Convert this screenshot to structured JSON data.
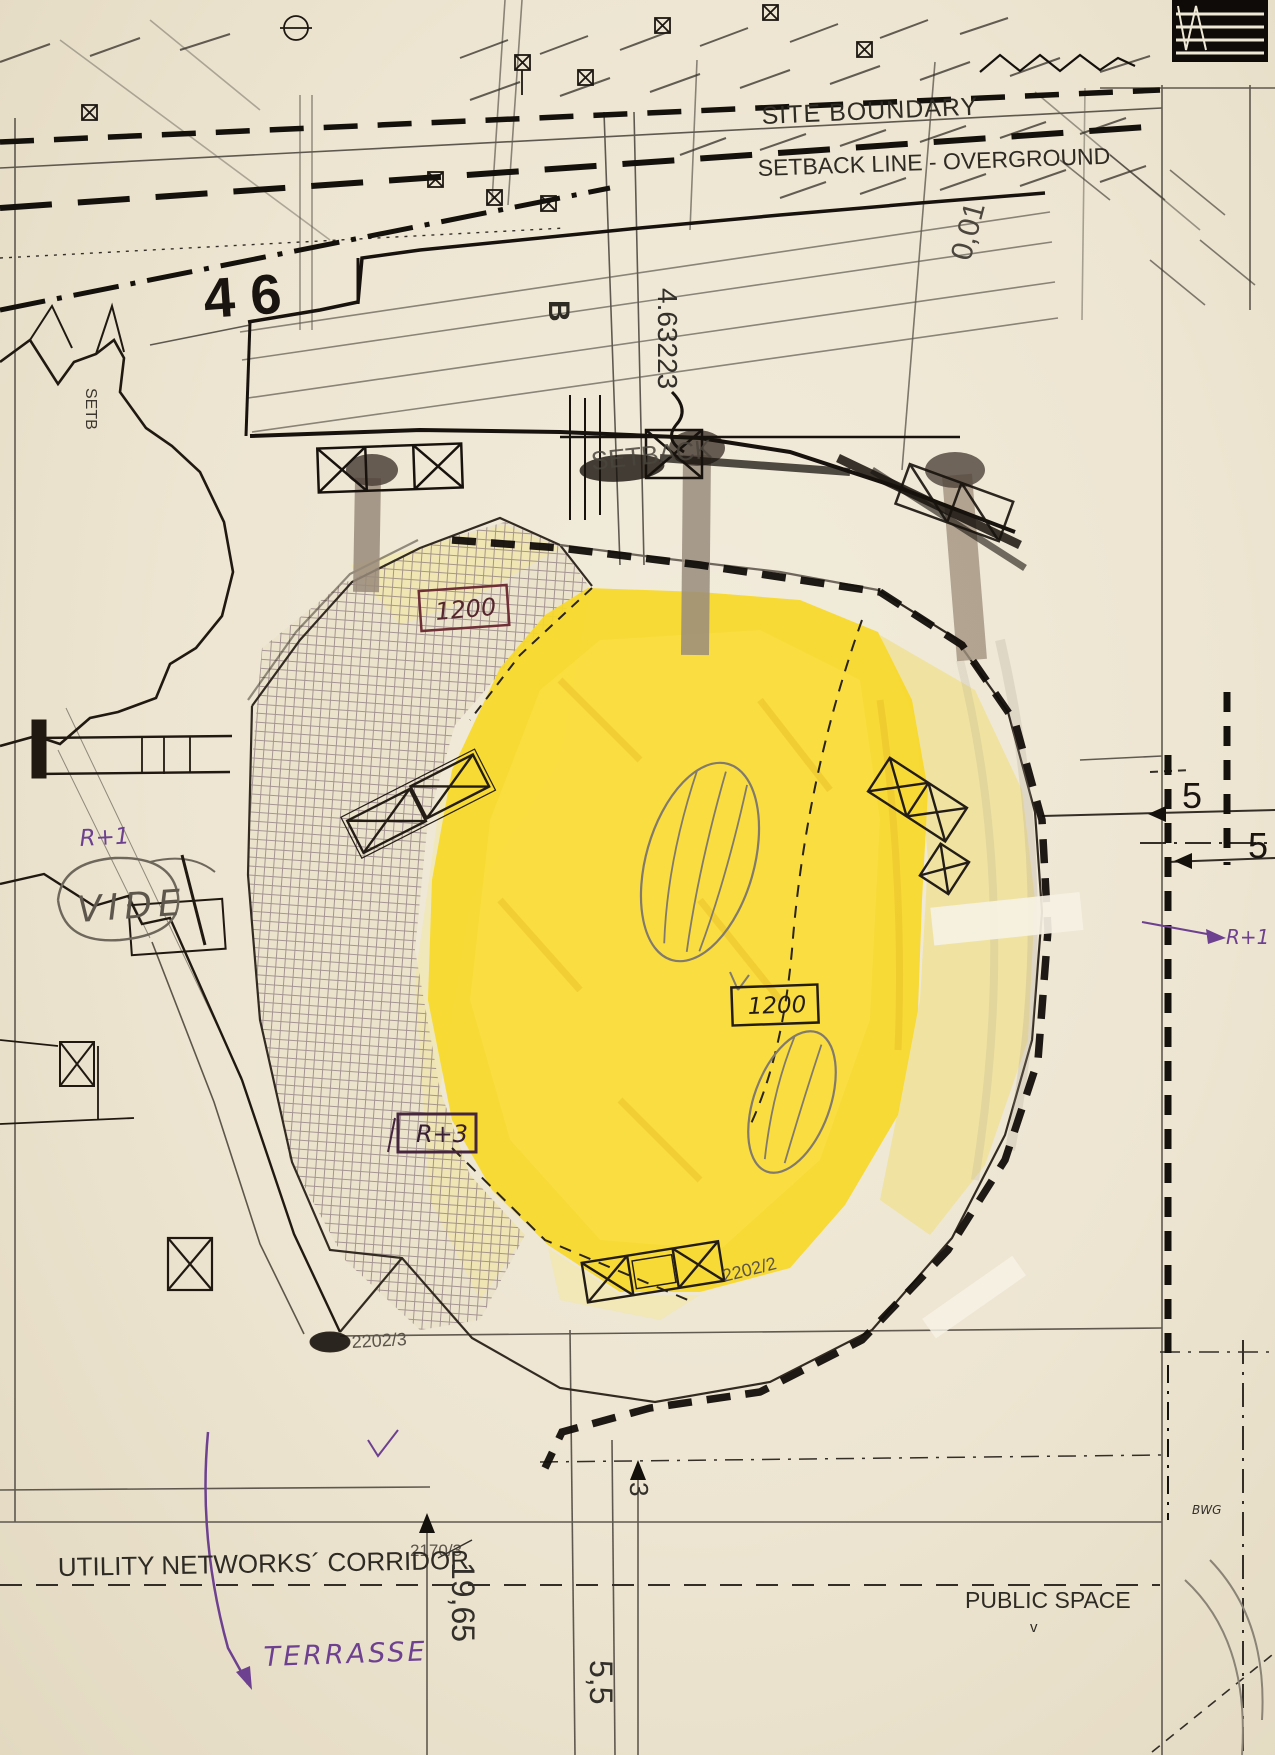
{
  "document": {
    "type": "scanned architectural site-plan sketch",
    "palette": {
      "paper": "#ede5d1",
      "ink": "#1f1911",
      "print_gray": "#4a453d",
      "pencil": "#80796c",
      "yellow_main": "#f7d829",
      "yellow_pale": "#f0e194",
      "purple_annotation": "#6d4190",
      "maroon_pen": "#6e2f36",
      "hatch_grid": "#74616c",
      "column_tan": "#9a8b7b"
    }
  },
  "labels": {
    "site_boundary": "SITE BOUNDARY",
    "setback_overground": "SETBACK LINE - OVERGROUND",
    "dim_001": "0,01",
    "parcel_46": "4 6",
    "letter_b": "B",
    "dim_463223": "4.63223",
    "setb_left": "SETB",
    "setback_mid": "SETBACK",
    "box_1200_top": "1200",
    "box_1200_mid": "1200",
    "box_r3": "R+3",
    "r1_left": "R+1",
    "vide": "VIDE",
    "r1_right": "R+1",
    "five_upper": "5",
    "five_right": "5",
    "parcel_2202_2": "2202/2",
    "parcel_2202_3": "2202/3",
    "parcel_2170_3": "2170/3",
    "utility_corridor": "UTILITY NETWORKS´ CORRIDOR",
    "public_space": "PUBLIC SPACE",
    "public_space_tick": "v",
    "terrasse": "TERRASSE",
    "dim_19_65": "19,65",
    "dim_5_5": "5,5",
    "dim_3": "3",
    "bwg": "BWG"
  }
}
